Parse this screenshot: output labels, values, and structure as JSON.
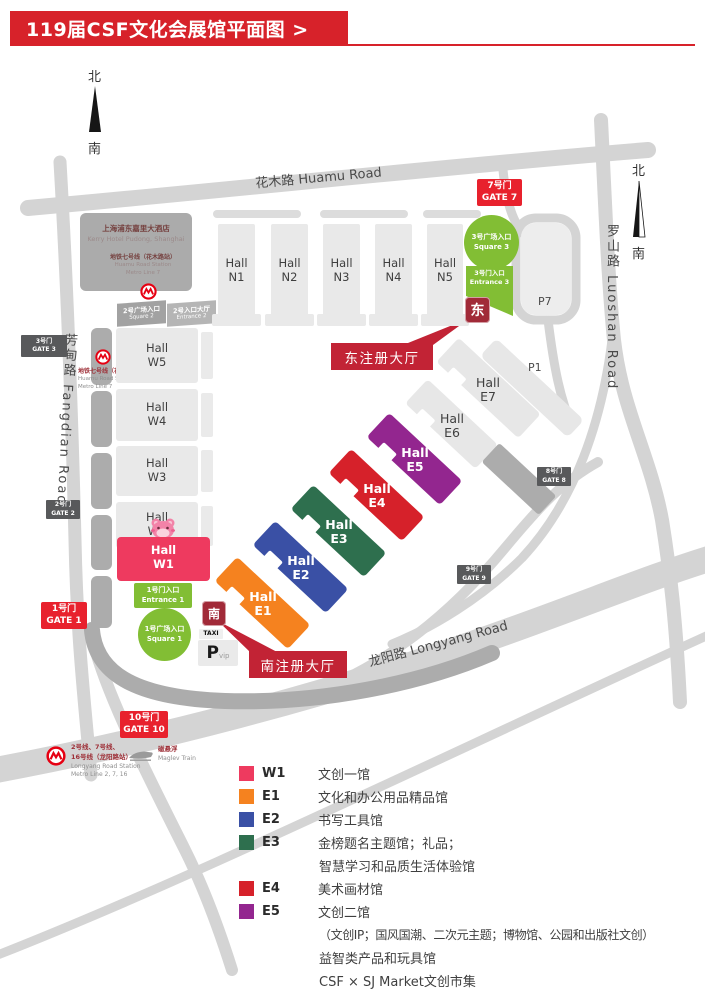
{
  "header": {
    "title": "119届CSF文化会展馆平面图 >"
  },
  "compass": {
    "north": "北",
    "south": "南"
  },
  "roads": {
    "huamu": "花木路 Huamu Road",
    "fangdian": "芳甸路 Fangdian Road",
    "luoshan": "罗山路 Luoshan Road",
    "longyang": "龙阳路 Longyang Road"
  },
  "hotel": {
    "name_zh": "上海浦东嘉里大酒店",
    "name_en": "Kerry Hotel Pudong, Shanghai",
    "metro_zh": "地铁七号线（花木路站）",
    "metro_en1": "Huamu Road Station",
    "metro_en2": "Metro Line 7"
  },
  "station_west": {
    "zh": "地铁七号线（花木路站）",
    "en1": "Huamu Road Station",
    "en2": "Metro Line 7"
  },
  "gates": {
    "g1": {
      "zh": "1号门",
      "en": "GATE 1"
    },
    "g2": {
      "zh": "2号门",
      "en": "GATE 2"
    },
    "g3": {
      "zh": "3号门",
      "en": "GATE 3"
    },
    "g7": {
      "zh": "7号门",
      "en": "GATE 7"
    },
    "g8": {
      "zh": "8号门",
      "en": "GATE 8"
    },
    "g9": {
      "zh": "9号门",
      "en": "GATE 9"
    },
    "g10": {
      "zh": "10号门",
      "en": "GATE 10"
    }
  },
  "plazas": {
    "square1": {
      "zh": "1号广场入口",
      "en": "Square 1"
    },
    "entrance1": {
      "zh": "1号门入口",
      "en": "Entrance 1"
    },
    "square2": {
      "zh": "2号广场入口",
      "en": "Square 2"
    },
    "entrance2": {
      "zh": "2号入口大厅",
      "en": "Entrance 2"
    },
    "square3": {
      "zh": "3号广场入口",
      "en": "Square 3"
    },
    "entrance3": {
      "zh": "3号门入口",
      "en": "Entrance 3"
    }
  },
  "markers": {
    "east": "东",
    "south": "南",
    "east_reg": "东注册大厅",
    "south_reg": "南注册大厅"
  },
  "parking": {
    "p7": "P7",
    "p1": "P1",
    "p_letter": "P",
    "vip": "vip",
    "taxi": "TAXI"
  },
  "halls": {
    "n": [
      {
        "l1": "Hall",
        "l2": "N1"
      },
      {
        "l1": "Hall",
        "l2": "N2"
      },
      {
        "l1": "Hall",
        "l2": "N3"
      },
      {
        "l1": "Hall",
        "l2": "N4"
      },
      {
        "l1": "Hall",
        "l2": "N5"
      }
    ],
    "w": [
      {
        "l1": "Hall",
        "l2": "W5"
      },
      {
        "l1": "Hall",
        "l2": "W4"
      },
      {
        "l1": "Hall",
        "l2": "W3"
      },
      {
        "l1": "Hall",
        "l2": "W2"
      }
    ],
    "w1": {
      "l1": "Hall",
      "l2": "W1"
    },
    "e": [
      {
        "l1": "Hall",
        "l2": "E1"
      },
      {
        "l1": "Hall",
        "l2": "E2"
      },
      {
        "l1": "Hall",
        "l2": "E3"
      },
      {
        "l1": "Hall",
        "l2": "E4"
      },
      {
        "l1": "Hall",
        "l2": "E5"
      },
      {
        "l1": "Hall",
        "l2": "E6"
      },
      {
        "l1": "Hall",
        "l2": "E7"
      }
    ]
  },
  "transport_legend": {
    "metro_zh1": "2号线、7号线、",
    "metro_zh2": "16号线（龙阳路站）",
    "metro_en1": "Longyang Road Station",
    "metro_en2": "Metro Line 2, 7, 16",
    "maglev_zh": "磁悬浮",
    "maglev_en": "Maglev Train"
  },
  "legend": {
    "items": [
      {
        "code": "W1",
        "color": "#EE3A5F",
        "desc": [
          "文创一馆"
        ]
      },
      {
        "code": "E1",
        "color": "#F5821F",
        "desc": [
          "文化和办公用品精品馆"
        ]
      },
      {
        "code": "E2",
        "color": "#3A50A5",
        "desc": [
          "书写工具馆"
        ]
      },
      {
        "code": "E3",
        "color": "#2E6F4E",
        "desc": [
          "金榜题名主题馆；礼品；",
          "智慧学习和品质生活体验馆"
        ]
      },
      {
        "code": "E4",
        "color": "#D6212A",
        "desc": [
          "美术画材馆"
        ]
      },
      {
        "code": "E5",
        "color": "#93268F",
        "desc": [
          "文创二馆",
          "（文创IP；国风国潮、二次元主题；博物馆、公园和出版社文创）",
          "益智类产品和玩具馆",
          "CSF × SJ Market文创市集"
        ]
      }
    ]
  },
  "colors": {
    "banner_red": "#D7222A",
    "gate_red": "#E8212D",
    "reg_label_red": "#C22335",
    "marker_dark_red": "#A12A38",
    "entrance_green": "#82BE34",
    "hall_w1": "#EE3A5F",
    "hall_e1": "#F5821F",
    "hall_e2": "#3A50A5",
    "hall_e3": "#2E6F4E",
    "hall_e4": "#D6212A",
    "hall_e5": "#93268F",
    "badge_gray": "#58595B",
    "metro_red": "#E60012"
  }
}
